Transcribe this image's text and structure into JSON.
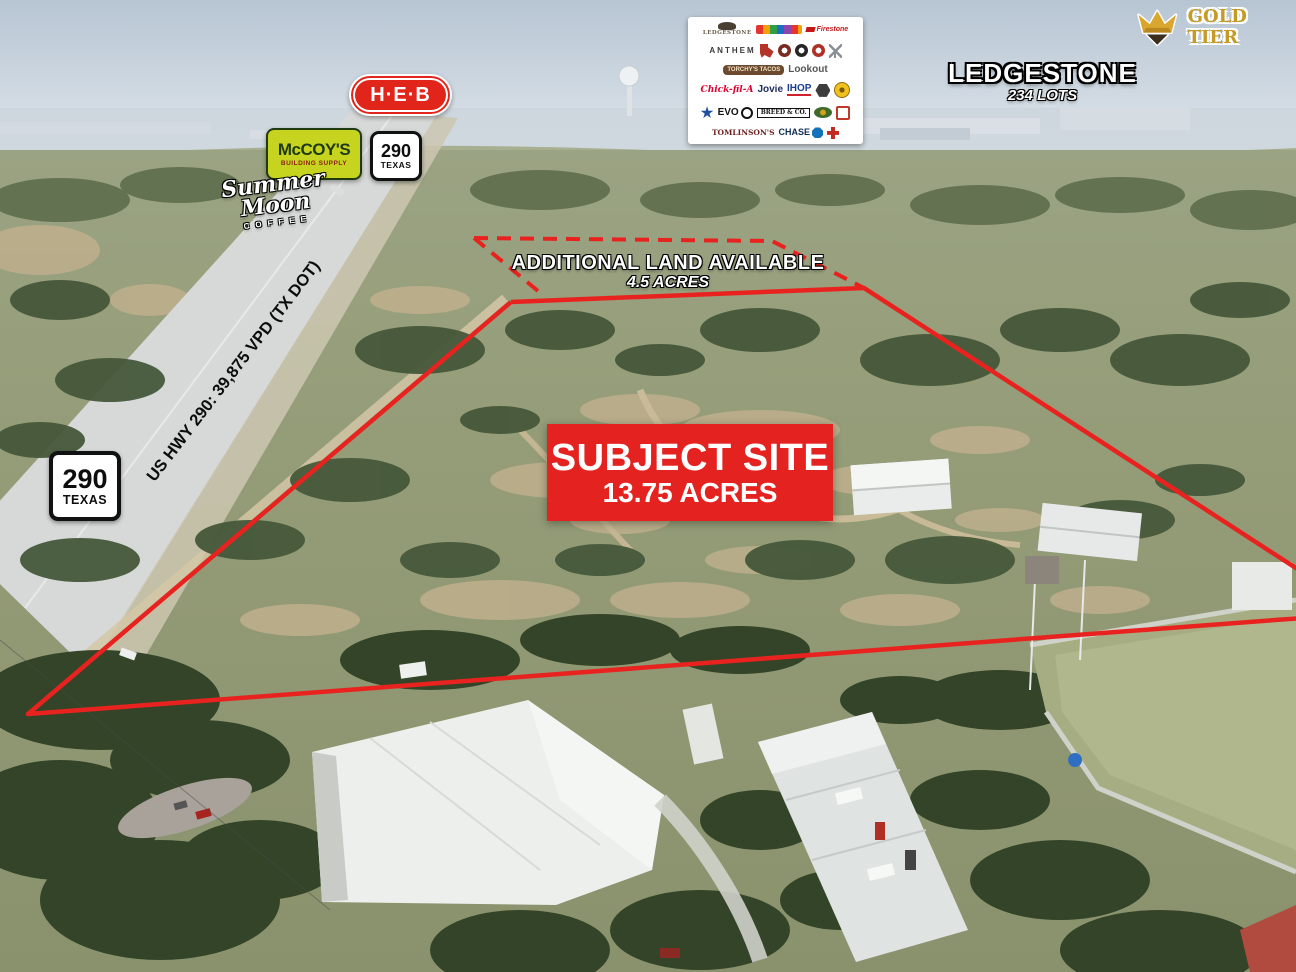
{
  "annotations": {
    "subject_site_title": "SUBJECT SITE",
    "subject_site_acres": "13.75 ACRES",
    "additional_land_title": "ADDITIONAL LAND AVAILABLE",
    "additional_land_acres": "4.5 ACRES",
    "ledgestone_title": "LEDGESTONE",
    "ledgestone_lots": "234 LOTS",
    "highway_traffic_label": "US HWY 290: 39,875 VPD (TX DOT)"
  },
  "badges": {
    "gold_tier": "GOLD TIER",
    "heb": "H·E·B",
    "mccoys_line1": "McCOY'S",
    "mccoys_line2": "BUILDING SUPPLY",
    "summer_moon_line1": "Summer Moon",
    "summer_moon_line2": "COFFEE",
    "route_number": "290",
    "route_state": "TEXAS"
  },
  "colors": {
    "boundary_red": "#e8231f",
    "subject_box_red": "#e42320",
    "heb_red": "#e1251b",
    "mccoys_yellow": "#c6d31f",
    "gold_tier_gold": "#c59a25"
  },
  "logo_panel": {
    "items": [
      {
        "name": "ledgestone-logo",
        "label": "LEDGESTONE"
      },
      {
        "name": "colorful-letters-logo",
        "label": ""
      },
      {
        "name": "firestone-logo",
        "label": "Firestone"
      },
      {
        "name": "anthem-apartment-homes-logo",
        "label": "ANTHEM"
      },
      {
        "name": "texas-badge-logo",
        "label": ""
      },
      {
        "name": "round-emblem-maroon-logo",
        "label": ""
      },
      {
        "name": "round-emblem-black-logo",
        "label": ""
      },
      {
        "name": "round-emblem-red-logo",
        "label": ""
      },
      {
        "name": "windmill-logo",
        "label": ""
      },
      {
        "name": "torchys-tacos-logo",
        "label": "TORCHY'S TACOS"
      },
      {
        "name": "lookout-logo",
        "label": "Lookout"
      },
      {
        "name": "chick-fil-a-logo",
        "label": "Chick-fil-A"
      },
      {
        "name": "jovie-logo",
        "label": "Jovie"
      },
      {
        "name": "ihop-logo",
        "label": "IHOP"
      },
      {
        "name": "hexagon-emblem-logo",
        "label": ""
      },
      {
        "name": "golds-gym-logo",
        "label": ""
      },
      {
        "name": "star-emblem-logo",
        "label": ""
      },
      {
        "name": "evo-logo",
        "label": "EVO"
      },
      {
        "name": "breed-and-co-logo",
        "label": "BREED & CO."
      },
      {
        "name": "green-gold-badge-logo",
        "label": ""
      },
      {
        "name": "red-badge-logo",
        "label": ""
      },
      {
        "name": "tomlinsons-logo",
        "label": "TOMLINSON'S"
      },
      {
        "name": "chase-logo",
        "label": "CHASE"
      },
      {
        "name": "medical-cross-logo",
        "label": ""
      }
    ]
  }
}
